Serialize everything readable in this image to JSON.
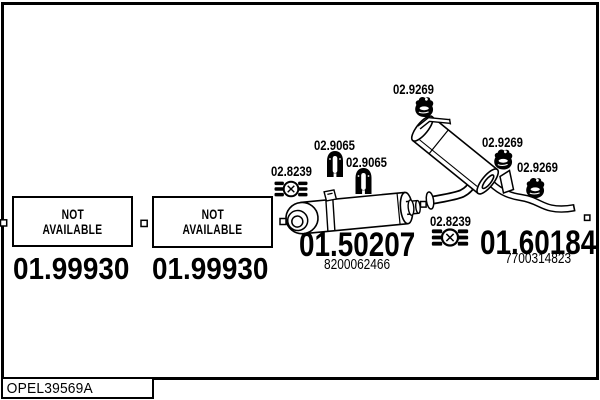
{
  "colors": {
    "ink": "#000000",
    "paper": "#ffffff"
  },
  "footer": {
    "code": "OPEL39569A"
  },
  "not_available": {
    "boxes": [
      {
        "label_line1": "NOT",
        "label_line2": "AVAILABLE",
        "part_number": "01.99930"
      },
      {
        "label_line1": "NOT",
        "label_line2": "AVAILABLE",
        "part_number": "01.99930"
      }
    ]
  },
  "center_muffler": {
    "part_number": "01.50207",
    "ref_number": "8200062466"
  },
  "rear_muffler": {
    "part_number": "01.60184",
    "ref_number": "7700314823"
  },
  "mount_labels": [
    {
      "icon": "exhaust-clamp-icon",
      "part_number": "02.8239"
    },
    {
      "icon": "rubber-hanger-icon",
      "part_number": "02.9065"
    },
    {
      "icon": "rubber-hanger-icon",
      "part_number": "02.9065"
    },
    {
      "icon": "rubber-mount-icon",
      "part_number": "02.9269"
    },
    {
      "icon": "rubber-mount-icon",
      "part_number": "02.9269"
    },
    {
      "icon": "rubber-mount-icon",
      "part_number": "02.9269"
    },
    {
      "icon": "exhaust-clamp-icon",
      "part_number": "02.8239"
    }
  ]
}
